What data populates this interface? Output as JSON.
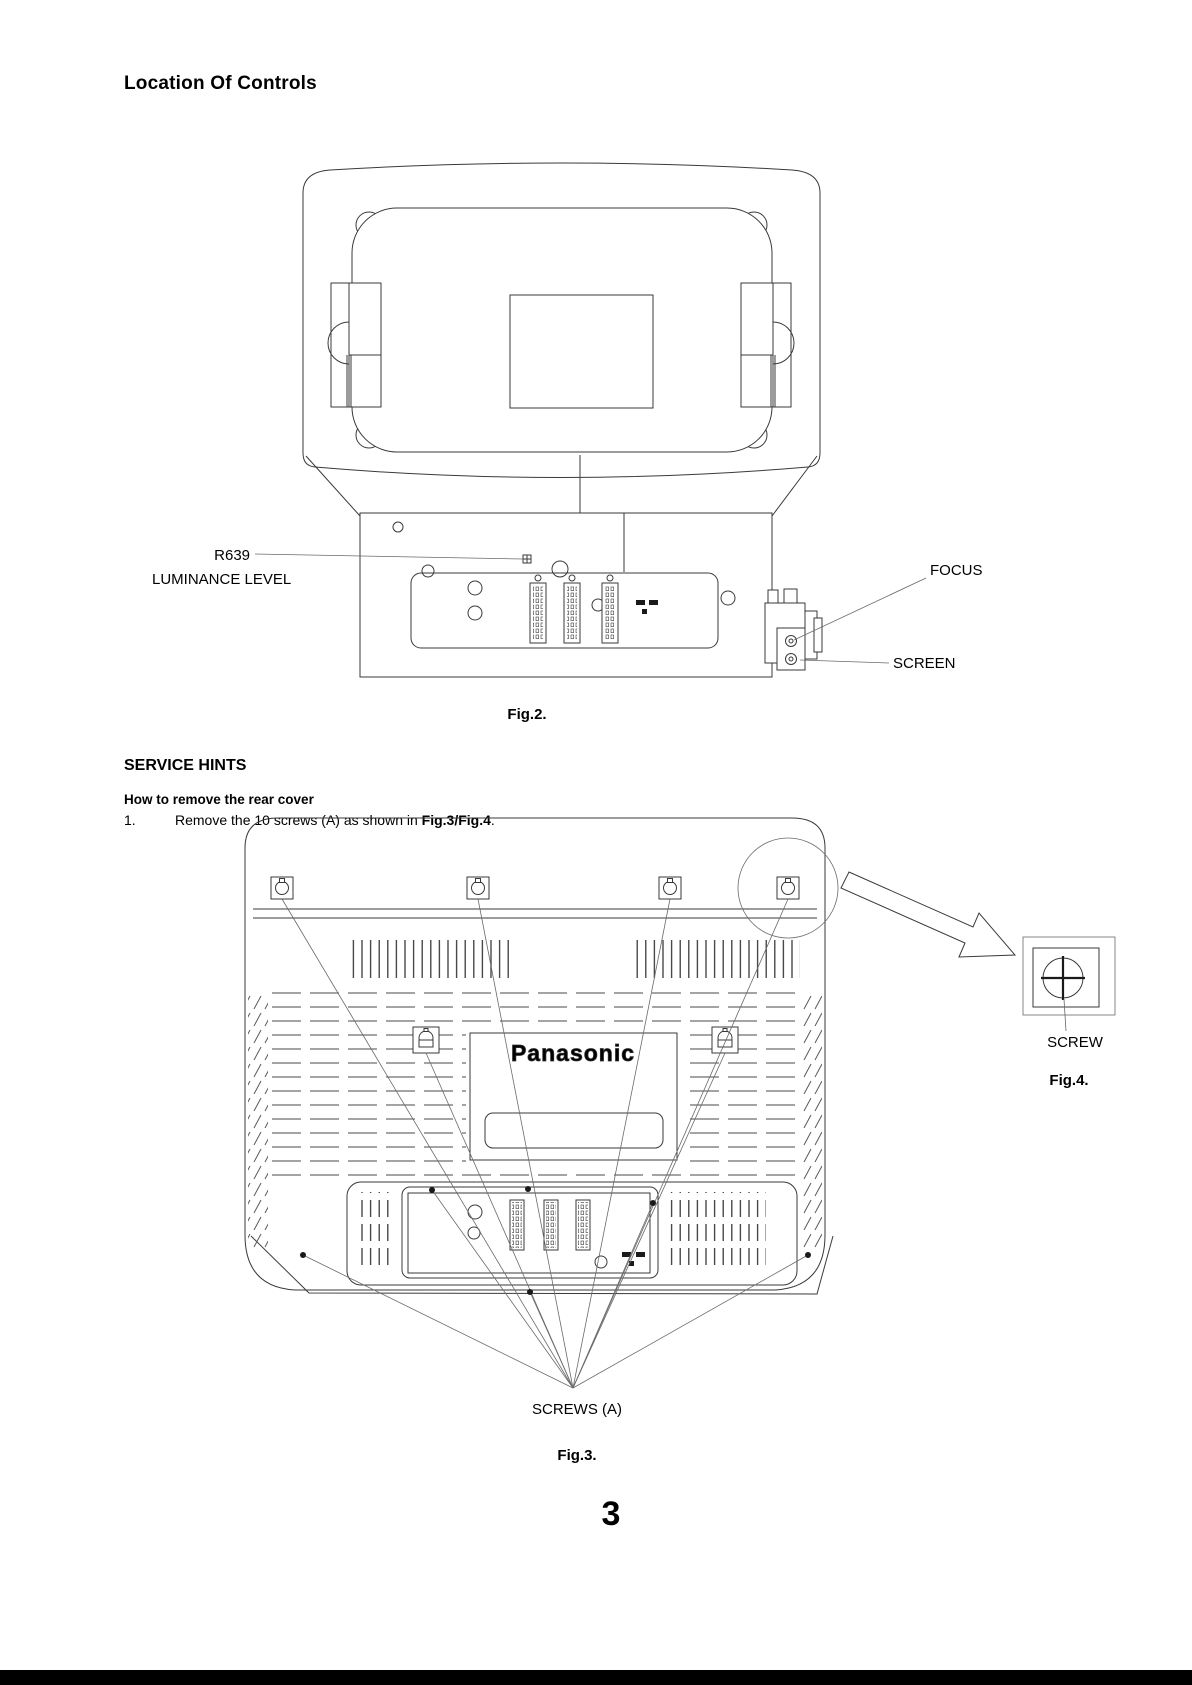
{
  "page": {
    "title": "Location Of Controls",
    "page_number": "3"
  },
  "colors": {
    "line": "#3a3a3a",
    "text": "#000000",
    "footer_bar": "#000000"
  },
  "fig2": {
    "caption": "Fig.2.",
    "labels": {
      "r639": "R639",
      "luminance": "LUMINANCE LEVEL",
      "focus": "FOCUS",
      "screen": "SCREEN"
    }
  },
  "service_hints": {
    "heading": "SERVICE HINTS",
    "subheading": "How to remove the rear cover",
    "step1": {
      "number": "1.",
      "text_pre": "Remove the 10 screws (A) as shown in ",
      "text_bold": "Fig.3/Fig.4",
      "text_post": "."
    }
  },
  "fig3": {
    "caption": "Fig.3.",
    "brand": "Panasonic",
    "labels": {
      "screws": "SCREWS (A)"
    }
  },
  "fig4": {
    "caption": "Fig.4.",
    "labels": {
      "screw": "SCREW"
    }
  }
}
